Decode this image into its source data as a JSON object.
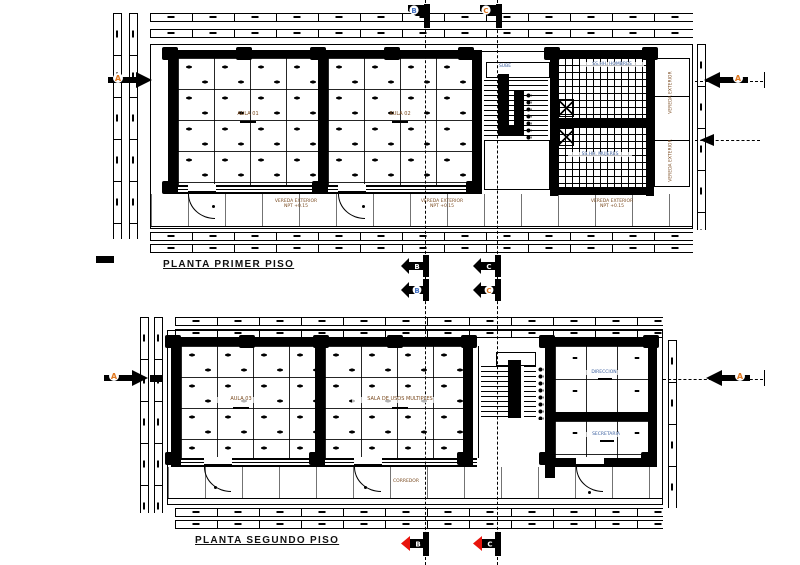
{
  "canvas": {
    "width": 800,
    "height": 565,
    "background": "#ffffff",
    "ink": "#000000"
  },
  "titles": {
    "floor1": "PLANTA PRIMER PISO",
    "floor2": "PLANTA SEGUNDO PISO"
  },
  "floor1": {
    "aula1": "AULA 01",
    "aula2": "AULA 02",
    "bath_men": "SS.HH. HOMBRES",
    "bath_women": "SS.HH. MUJERES",
    "stair": "SUBE",
    "vereda_line1": "VEREDA EXTERIOR",
    "vereda_line2": "NPT +0.15",
    "side_room": "VEREDA EXTERIOR"
  },
  "floor2": {
    "aula3": "AULA 03",
    "sala": "SALA DE USOS MULTIPLES",
    "direccion": "DIRECCION",
    "secretaria": "SECRETARIA",
    "corredor": "CORREDOR"
  },
  "markers": {
    "a": "A",
    "b": "B",
    "c": "C"
  },
  "colors": {
    "ink": "#000000",
    "label_brown": "#7a4a1f",
    "label_blue": "#3a5f9f",
    "marker_blue": "#4472c4",
    "marker_orange": "#e07820",
    "marker_red": "#e8140c"
  }
}
